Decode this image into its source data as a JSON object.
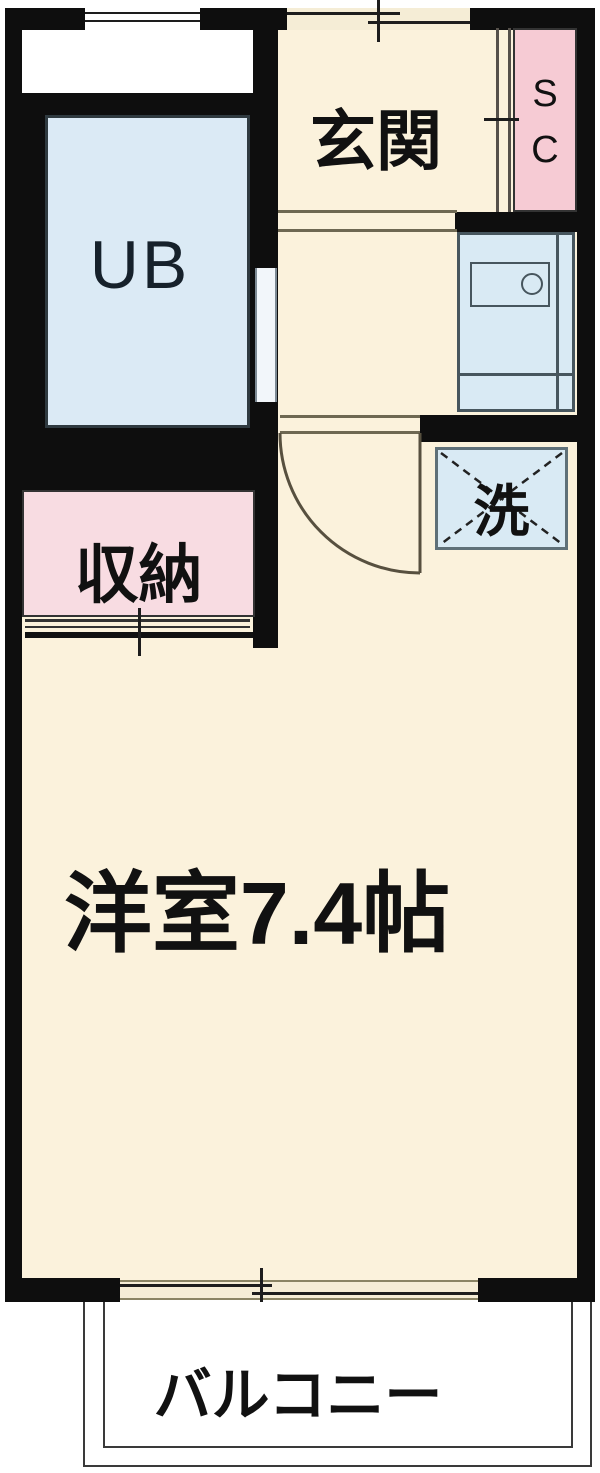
{
  "rooms": {
    "entrance": {
      "label": "玄関"
    },
    "shoe_closet": {
      "label": "SC",
      "letters": [
        "S",
        "C"
      ]
    },
    "unit_bath": {
      "label": "UB"
    },
    "storage": {
      "label": "収納"
    },
    "laundry": {
      "label": "洗"
    },
    "western_room": {
      "label": "洋室7.4帖"
    },
    "balcony": {
      "label": "バルコニー"
    }
  },
  "colors": {
    "wall": "#0e0e0e",
    "floor_cream": "#FBF2DC",
    "room_blue": "#DBEAF5",
    "shoe_closet_pink": "#F6CBD4",
    "storage_pink": "#F8DCE2",
    "balcony_white": "#FFFFFF",
    "fixture_outline": "#47565E",
    "threshold_khaki": "#6E6852"
  }
}
